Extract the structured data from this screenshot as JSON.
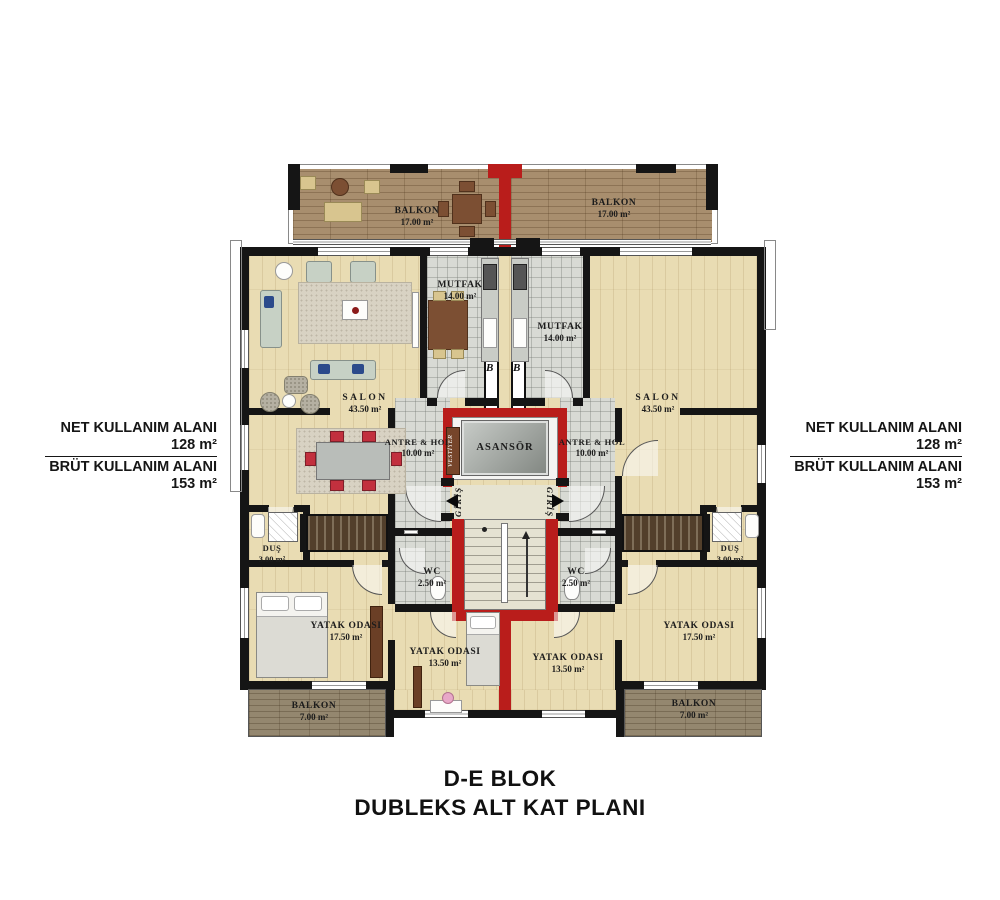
{
  "title": {
    "line1": "D-E BLOK",
    "line2": "DUBLEKS ALT KAT PLANI"
  },
  "annotations": {
    "left": {
      "net_label": "NET KULLANIM ALANI",
      "net_value": "128 m²",
      "brut_label": "BRÜT KULLANIM ALANI",
      "brut_value": "153 m²"
    },
    "right": {
      "net_label": "NET KULLANIM ALANI",
      "net_value": "128 m²",
      "brut_label": "BRÜT KULLANIM ALANI",
      "brut_value": "153 m²"
    }
  },
  "rooms": {
    "balkon_tl": {
      "name": "BALKON",
      "area": "17.00 m²"
    },
    "balkon_tr": {
      "name": "BALKON",
      "area": "17.00 m²"
    },
    "mutfak_l": {
      "name": "MUTFAK",
      "area": "14.00 m²"
    },
    "mutfak_r": {
      "name": "MUTFAK",
      "area": "14.00 m²"
    },
    "salon_l": {
      "name": "SALON",
      "area": "43.50 m²"
    },
    "salon_r": {
      "name": "SALON",
      "area": "43.50 m²"
    },
    "antre_l": {
      "name": "ANTRE & HOL",
      "area": "10.00 m²"
    },
    "antre_r": {
      "name": "ANTRE & HOL",
      "area": "10.00 m²"
    },
    "asansor": {
      "name": "ASANSÖR"
    },
    "vestiyer": {
      "name": "VESTİYER"
    },
    "giris_l": {
      "name": "GİRİŞ"
    },
    "giris_r": {
      "name": "GİRİŞ"
    },
    "wc_l": {
      "name": "WC",
      "area": "2.50 m²"
    },
    "wc_r": {
      "name": "WC",
      "area": "2.50 m²"
    },
    "dus_l": {
      "name": "DUŞ",
      "area": "3.00 m²"
    },
    "dus_r": {
      "name": "DUŞ",
      "area": "3.00 m²"
    },
    "yatak_b_l": {
      "name": "YATAK ODASI",
      "area": "17.50 m²"
    },
    "yatak_b_r": {
      "name": "YATAK ODASI",
      "area": "17.50 m²"
    },
    "yatak_k_l": {
      "name": "YATAK ODASI",
      "area": "13.50 m²"
    },
    "yatak_k_r": {
      "name": "YATAK ODASI",
      "area": "13.50 m²"
    },
    "balkon_bl": {
      "name": "BALKON",
      "area": "7.00 m²"
    },
    "balkon_br": {
      "name": "BALKON",
      "area": "7.00 m²"
    }
  },
  "markers": {
    "b_left": "B",
    "b_right": "B"
  },
  "colors": {
    "wall": "#151515",
    "red_wall": "#b91d1b",
    "wood_floor": "#e9dcb3",
    "upper_balcony_wood": "#a88e6e",
    "lower_balcony_wood": "#94876f",
    "tile": "#d8dad4",
    "dark_stairs": "#523f2b",
    "text": "#1a1a1a"
  }
}
